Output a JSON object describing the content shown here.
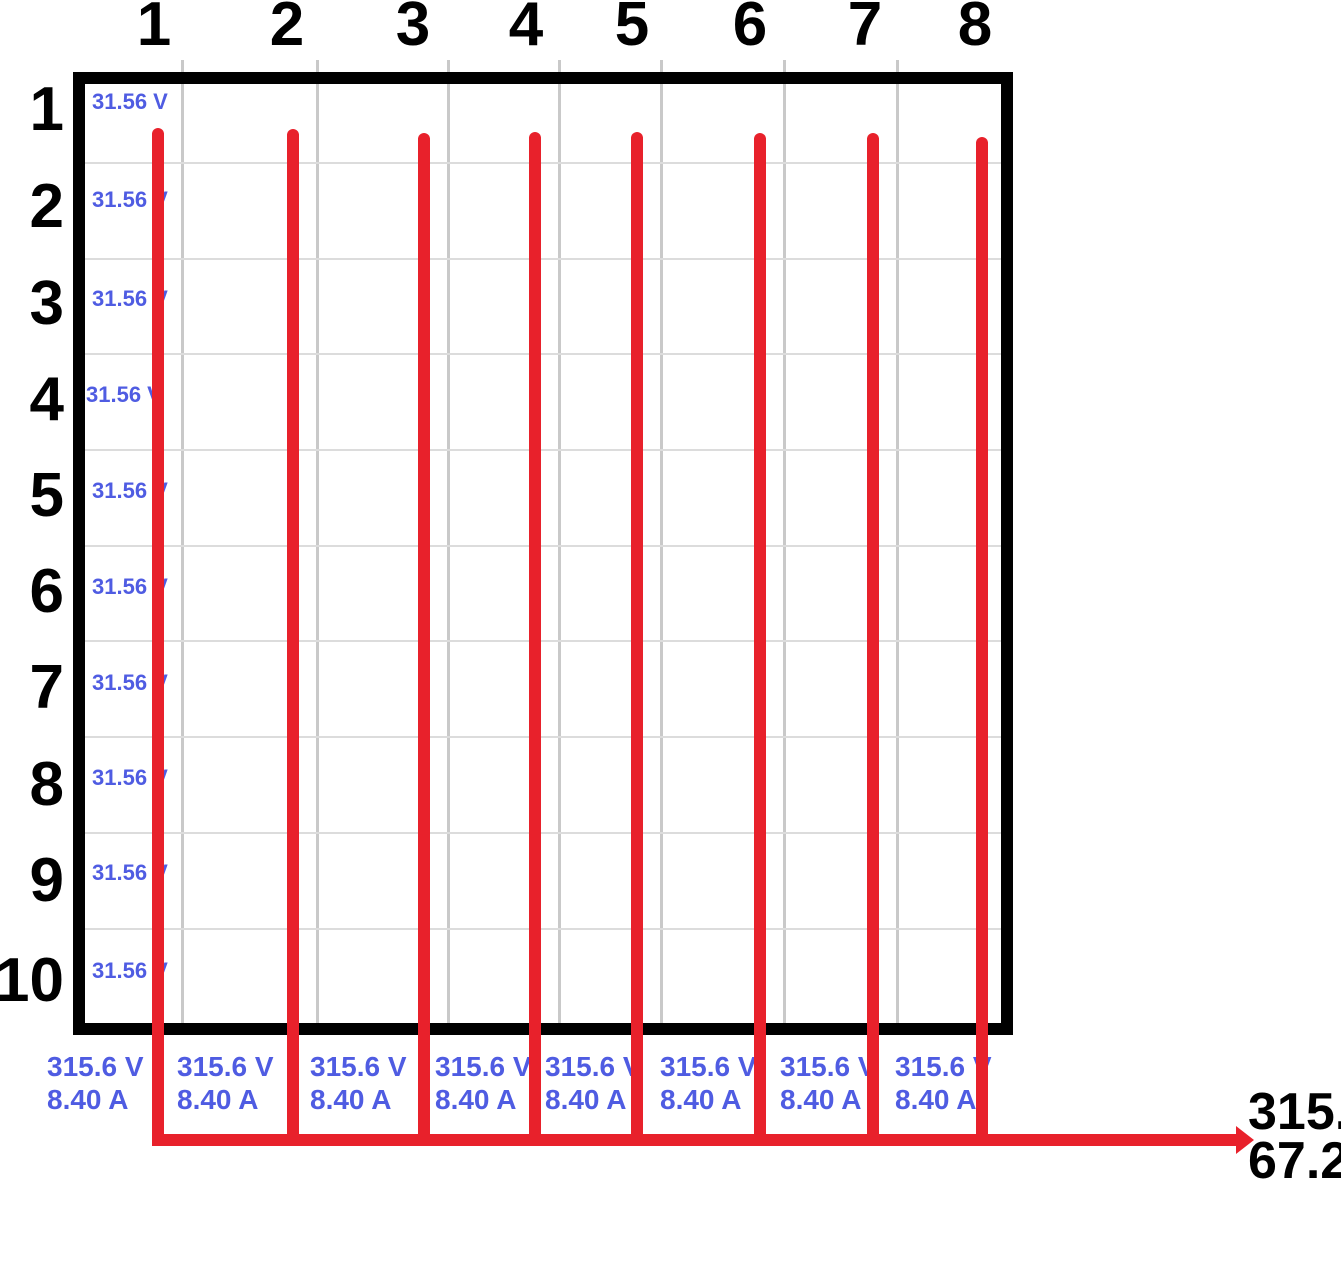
{
  "colors": {
    "wire-red": "#e8212b",
    "label-blue": "#4f5ce2",
    "grid-vertical": "#c9c9c9",
    "grid-horizontal": "#dcdcdc",
    "border-black": "#000000",
    "text-black": "#000000"
  },
  "columns": [
    {
      "number": "1",
      "voltage": "315.6 V",
      "current": "8.40 A"
    },
    {
      "number": "2",
      "voltage": "315.6 V",
      "current": "8.40 A"
    },
    {
      "number": "3",
      "voltage": "315.6 V",
      "current": "8.40 A"
    },
    {
      "number": "4",
      "voltage": "315.6 V",
      "current": "8.40 A"
    },
    {
      "number": "5",
      "voltage": "315.6 V",
      "current": "8.40 A"
    },
    {
      "number": "6",
      "voltage": "315.6 V",
      "current": "8.40 A"
    },
    {
      "number": "7",
      "voltage": "315.6 V",
      "current": "8.40 A"
    },
    {
      "number": "8",
      "voltage": "315.6 V",
      "current": "8.40 A"
    }
  ],
  "rows": [
    {
      "number": "1",
      "voltage": "31.56 V"
    },
    {
      "number": "2",
      "voltage": "31.56 V"
    },
    {
      "number": "3",
      "voltage": "31.56 V"
    },
    {
      "number": "4",
      "voltage": "31.56 V"
    },
    {
      "number": "5",
      "voltage": "31.56 V"
    },
    {
      "number": "6",
      "voltage": "31.56 V"
    },
    {
      "number": "7",
      "voltage": "31.56 V"
    },
    {
      "number": "8",
      "voltage": "31.56 V"
    },
    {
      "number": "9",
      "voltage": "31.56 V"
    },
    {
      "number": "10",
      "voltage": "31.56 V"
    }
  ],
  "output": {
    "voltage": "315.6 V",
    "current": "67.2 A"
  }
}
